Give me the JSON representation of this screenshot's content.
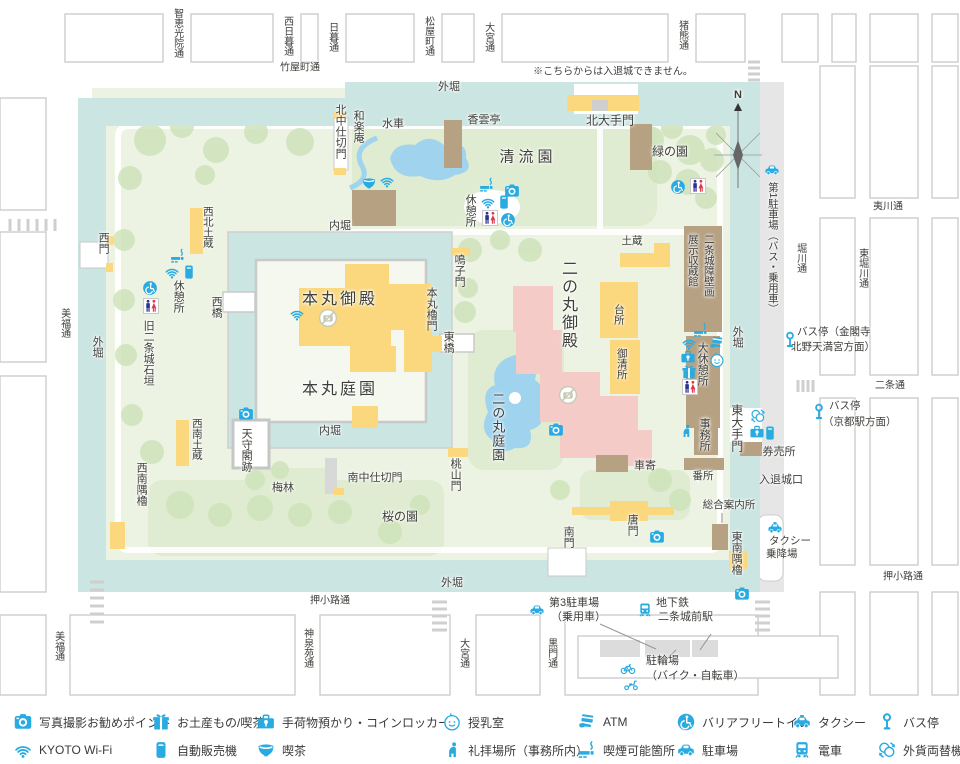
{
  "colors": {
    "blue": "#29ABE2",
    "moat": "#CBE5E2",
    "ground": "#EDF3E3",
    "lawn": "#DFECD1",
    "tree": "#CEE3BA",
    "pond": "#9FD3EE",
    "yellow": "#FBD87E",
    "pink": "#F5CBC8",
    "tan": "#B7A183",
    "grayline": "#C9C9C9",
    "sidewalk": "#E6E6E6",
    "text": "#3E3E3A",
    "male": "#2E3192",
    "female": "#E0374B"
  },
  "map": {
    "labels": [
      {
        "t": "智恵光院通",
        "o": "v",
        "x": 177,
        "y": 8,
        "s": 10
      },
      {
        "t": "西日暮通",
        "o": "v",
        "x": 287,
        "y": 16,
        "s": 10
      },
      {
        "t": "日暮通",
        "o": "v",
        "x": 332,
        "y": 22,
        "s": 10
      },
      {
        "t": "松屋町通",
        "o": "v",
        "x": 428,
        "y": 16,
        "s": 10
      },
      {
        "t": "大宮通",
        "o": "v",
        "x": 488,
        "y": 22,
        "s": 10
      },
      {
        "t": "猪熊通",
        "o": "v",
        "x": 682,
        "y": 20,
        "s": 10
      },
      {
        "t": "竹屋町通",
        "o": "h",
        "x": 300,
        "y": 68,
        "s": 10
      },
      {
        "t": "※こちらからは入退城できません。",
        "o": "h",
        "x": 613,
        "y": 72,
        "s": 10
      },
      {
        "t": "外堀",
        "o": "h",
        "x": 449,
        "y": 87,
        "s": 11
      },
      {
        "t": "N",
        "o": "h",
        "x": 738,
        "y": 95,
        "s": 11,
        "b": 1
      },
      {
        "t": "北大手門",
        "o": "h",
        "x": 610,
        "y": 121,
        "s": 12
      },
      {
        "t": "緑の園",
        "o": "h",
        "x": 670,
        "y": 152,
        "s": 12
      },
      {
        "t": "清流園",
        "o": "h",
        "x": 528,
        "y": 158,
        "s": 15,
        "ls": 4
      },
      {
        "t": "水車",
        "o": "h",
        "x": 393,
        "y": 124,
        "s": 11
      },
      {
        "t": "香雲亭",
        "o": "h",
        "x": 484,
        "y": 120,
        "s": 11
      },
      {
        "t": "和楽庵",
        "o": "v",
        "x": 358,
        "y": 110,
        "s": 11
      },
      {
        "t": "北中仕切門",
        "o": "v",
        "x": 340,
        "y": 104,
        "s": 11
      },
      {
        "t": "休憩所",
        "o": "v",
        "x": 470,
        "y": 194,
        "s": 11
      },
      {
        "t": "土蔵",
        "o": "h",
        "x": 632,
        "y": 242,
        "s": 10.5
      },
      {
        "t": "西北土蔵",
        "o": "v",
        "x": 207,
        "y": 206,
        "s": 10.5
      },
      {
        "t": "内堀",
        "o": "h",
        "x": 340,
        "y": 226,
        "s": 11
      },
      {
        "t": "鳴子門",
        "o": "v",
        "x": 459,
        "y": 254,
        "s": 11
      },
      {
        "t": "西門",
        "o": "v",
        "x": 103,
        "y": 232,
        "s": 11
      },
      {
        "t": "休憩所",
        "o": "v",
        "x": 178,
        "y": 280,
        "s": 11
      },
      {
        "t": "旧二条城石垣",
        "o": "v",
        "x": 148,
        "y": 320,
        "s": 11
      },
      {
        "t": "本丸御殿",
        "o": "h",
        "x": 340,
        "y": 300,
        "s": 16,
        "ls": 3
      },
      {
        "t": "本丸庭園",
        "o": "h",
        "x": 340,
        "y": 390,
        "s": 16,
        "ls": 3
      },
      {
        "t": "本丸櫓門",
        "o": "v",
        "x": 431,
        "y": 287,
        "s": 11
      },
      {
        "t": "東橋",
        "o": "v",
        "x": 448,
        "y": 331,
        "s": 11
      },
      {
        "t": "西橋",
        "o": "v",
        "x": 216,
        "y": 296,
        "s": 11
      },
      {
        "t": "二の丸御殿",
        "o": "v",
        "x": 567,
        "y": 260,
        "s": 16,
        "ls": 2
      },
      {
        "t": "台所",
        "o": "v",
        "x": 618,
        "y": 304,
        "s": 10.5
      },
      {
        "t": "御清所",
        "o": "v",
        "x": 621,
        "y": 348,
        "s": 10.5
      },
      {
        "t": "展示収蔵館",
        "o": "v",
        "x": 692,
        "y": 234,
        "s": 10.5
      },
      {
        "t": "二条城障壁画",
        "o": "v",
        "x": 708,
        "y": 234,
        "s": 10.5
      },
      {
        "t": "大休憩所",
        "o": "v",
        "x": 702,
        "y": 342,
        "s": 11
      },
      {
        "t": "事務所",
        "o": "v",
        "x": 704,
        "y": 418,
        "s": 11
      },
      {
        "t": "外堀",
        "o": "v",
        "x": 737,
        "y": 326,
        "s": 11
      },
      {
        "t": "外堀",
        "o": "v",
        "x": 97,
        "y": 336,
        "s": 11
      },
      {
        "t": "東大手門",
        "o": "v",
        "x": 736,
        "y": 404,
        "s": 12
      },
      {
        "t": "二の丸庭園",
        "o": "v",
        "x": 497,
        "y": 392,
        "s": 13,
        "ls": 1
      },
      {
        "t": "桜の園",
        "o": "h",
        "x": 400,
        "y": 517,
        "s": 12
      },
      {
        "t": "梅林",
        "o": "h",
        "x": 283,
        "y": 488,
        "s": 11
      },
      {
        "t": "天守閣跡",
        "o": "v",
        "x": 246,
        "y": 428,
        "s": 11
      },
      {
        "t": "西南土蔵",
        "o": "v",
        "x": 196,
        "y": 418,
        "s": 10.5
      },
      {
        "t": "西南隅櫓",
        "o": "v",
        "x": 141,
        "y": 462,
        "s": 11
      },
      {
        "t": "南中仕切門",
        "o": "h",
        "x": 375,
        "y": 478,
        "s": 11
      },
      {
        "t": "桃山門",
        "o": "v",
        "x": 455,
        "y": 458,
        "s": 11
      },
      {
        "t": "内堀",
        "o": "h",
        "x": 330,
        "y": 431,
        "s": 11
      },
      {
        "t": "車寄",
        "o": "h",
        "x": 645,
        "y": 466,
        "s": 11
      },
      {
        "t": "番所",
        "o": "h",
        "x": 703,
        "y": 477,
        "s": 10.5
      },
      {
        "t": "券売所",
        "o": "h",
        "x": 779,
        "y": 452,
        "s": 11
      },
      {
        "t": "入退城口",
        "o": "h",
        "x": 781,
        "y": 480,
        "s": 11
      },
      {
        "t": "総合案内所",
        "o": "h",
        "x": 729,
        "y": 506,
        "s": 10.5
      },
      {
        "t": "唐門",
        "o": "v",
        "x": 632,
        "y": 514,
        "s": 11
      },
      {
        "t": "南門",
        "o": "v",
        "x": 568,
        "y": 526,
        "s": 11
      },
      {
        "t": "東南隅櫓",
        "o": "v",
        "x": 736,
        "y": 531,
        "s": 11
      },
      {
        "t": "タクシー",
        "o": "h",
        "a": "l",
        "x": 769,
        "y": 542,
        "s": 10.5
      },
      {
        "t": "乗降場",
        "o": "h",
        "a": "l",
        "x": 766,
        "y": 555,
        "s": 10.5
      },
      {
        "t": "第1駐車場（バス・乗用車）",
        "o": "v",
        "x": 772,
        "y": 182,
        "s": 10.5
      },
      {
        "t": "バス停（金閣寺",
        "o": "h",
        "a": "l",
        "x": 797,
        "y": 333,
        "s": 10.5
      },
      {
        "t": "北野天満宮方面）",
        "o": "h",
        "a": "l",
        "x": 791,
        "y": 348,
        "s": 10.5
      },
      {
        "t": "バス停",
        "o": "h",
        "a": "l",
        "x": 829,
        "y": 407,
        "s": 10.5
      },
      {
        "t": "（京都駅方面）",
        "o": "h",
        "a": "l",
        "x": 823,
        "y": 423,
        "s": 10.5
      },
      {
        "t": "堀川通",
        "o": "v",
        "x": 800,
        "y": 243,
        "s": 10
      },
      {
        "t": "東堀川通",
        "o": "v",
        "x": 862,
        "y": 248,
        "s": 10
      },
      {
        "t": "夷川通",
        "o": "h",
        "x": 888,
        "y": 207,
        "s": 10
      },
      {
        "t": "二条通",
        "o": "h",
        "x": 890,
        "y": 386,
        "s": 10
      },
      {
        "t": "押小路通",
        "o": "h",
        "x": 903,
        "y": 577,
        "s": 10
      },
      {
        "t": "外堀",
        "o": "h",
        "x": 452,
        "y": 583,
        "s": 11
      },
      {
        "t": "押小路通",
        "o": "h",
        "x": 330,
        "y": 601,
        "s": 10
      },
      {
        "t": "第3駐車場",
        "o": "h",
        "a": "l",
        "x": 549,
        "y": 603,
        "s": 11
      },
      {
        "t": "（乗用車）",
        "o": "h",
        "a": "l",
        "x": 551,
        "y": 617,
        "s": 11
      },
      {
        "t": "地下鉄",
        "o": "h",
        "a": "l",
        "x": 656,
        "y": 603,
        "s": 11
      },
      {
        "t": "二条城前駅",
        "o": "h",
        "a": "l",
        "x": 658,
        "y": 617,
        "s": 11
      },
      {
        "t": "駐輪場",
        "o": "h",
        "a": "l",
        "x": 646,
        "y": 661,
        "s": 11
      },
      {
        "t": "（バイク・自転車）",
        "o": "h",
        "a": "l",
        "x": 646,
        "y": 676,
        "s": 11
      },
      {
        "t": "美福通",
        "o": "v",
        "x": 64,
        "y": 308,
        "s": 10
      },
      {
        "t": "美福通",
        "o": "v",
        "x": 58,
        "y": 631,
        "s": 10
      },
      {
        "t": "神泉苑通",
        "o": "v",
        "x": 307,
        "y": 628,
        "s": 10
      },
      {
        "t": "大宮通",
        "o": "v",
        "x": 463,
        "y": 638,
        "s": 10
      },
      {
        "t": "黒門通",
        "o": "v",
        "x": 551,
        "y": 638,
        "s": 10
      }
    ],
    "icons": [
      {
        "n": "camera",
        "x": 512,
        "y": 191
      },
      {
        "n": "camera",
        "x": 246,
        "y": 414
      },
      {
        "n": "camera",
        "x": 556,
        "y": 430
      },
      {
        "n": "camera",
        "x": 657,
        "y": 537
      },
      {
        "n": "camera",
        "x": 742,
        "y": 594
      },
      {
        "n": "nophoto",
        "x": 328,
        "y": 318,
        "sz": 19
      },
      {
        "n": "nophoto",
        "x": 568,
        "y": 395,
        "sz": 19
      },
      {
        "n": "wifi",
        "x": 387,
        "y": 181
      },
      {
        "n": "wifi",
        "x": 488,
        "y": 202
      },
      {
        "n": "wifi",
        "x": 297,
        "y": 314
      },
      {
        "n": "wifi",
        "x": 172,
        "y": 272
      },
      {
        "n": "wifi",
        "x": 689,
        "y": 343
      },
      {
        "n": "tea",
        "x": 369,
        "y": 183
      },
      {
        "n": "smoking",
        "x": 487,
        "y": 185
      },
      {
        "n": "smoking",
        "x": 178,
        "y": 256
      },
      {
        "n": "smoking",
        "x": 701,
        "y": 330
      },
      {
        "n": "vending",
        "x": 504,
        "y": 202
      },
      {
        "n": "vending",
        "x": 189,
        "y": 272
      },
      {
        "n": "vending",
        "x": 770,
        "y": 433
      },
      {
        "n": "toilets",
        "x": 490,
        "y": 218,
        "sz": 16
      },
      {
        "n": "toilets",
        "x": 151,
        "y": 306,
        "sz": 16
      },
      {
        "n": "toilets",
        "x": 698,
        "y": 186,
        "sz": 16
      },
      {
        "n": "toilets",
        "x": 690,
        "y": 387,
        "sz": 16
      },
      {
        "n": "accessible",
        "x": 508,
        "y": 220
      },
      {
        "n": "accessible",
        "x": 150,
        "y": 288
      },
      {
        "n": "accessible",
        "x": 678,
        "y": 187
      },
      {
        "n": "baby",
        "x": 717,
        "y": 360
      },
      {
        "n": "gift",
        "x": 689,
        "y": 372
      },
      {
        "n": "locker",
        "x": 688,
        "y": 357
      },
      {
        "n": "locker",
        "x": 757,
        "y": 432
      },
      {
        "n": "atm",
        "x": 717,
        "y": 343
      },
      {
        "n": "prayer",
        "x": 686,
        "y": 431
      },
      {
        "n": "car",
        "x": 772,
        "y": 170
      },
      {
        "n": "car",
        "x": 537,
        "y": 610
      },
      {
        "n": "train",
        "x": 645,
        "y": 610
      },
      {
        "n": "bus",
        "x": 790,
        "y": 340,
        "sz": 17
      },
      {
        "n": "bus",
        "x": 819,
        "y": 412,
        "sz": 17
      },
      {
        "n": "taxi",
        "x": 775,
        "y": 528
      },
      {
        "n": "exchange",
        "x": 758,
        "y": 416
      },
      {
        "n": "bicycle",
        "x": 628,
        "y": 668
      },
      {
        "n": "scooter",
        "x": 631,
        "y": 684
      }
    ]
  },
  "legend": {
    "row_y": [
      722,
      750
    ],
    "rows": [
      [
        {
          "icon": "camera",
          "label": "写真撮影お勧めポイント",
          "x": 14
        },
        {
          "icon": "gift",
          "label": "お土産もの/喫茶",
          "x": 152
        },
        {
          "icon": "locker",
          "label": "手荷物預かり・コインロッカー",
          "x": 257
        },
        {
          "icon": "baby",
          "label": "授乳室",
          "x": 443
        },
        {
          "icon": "atm",
          "label": "ATM",
          "x": 578
        },
        {
          "icon": "accessible",
          "label": "バリアフリートイレ",
          "x": 677
        },
        {
          "icon": "taxi",
          "label": "タクシー",
          "x": 793
        },
        {
          "icon": "bus",
          "label": "バス停",
          "x": 878
        }
      ],
      [
        {
          "icon": "wifi",
          "label": "KYOTO Wi-Fi",
          "x": 14
        },
        {
          "icon": "vending",
          "label": "自動販売機",
          "x": 152
        },
        {
          "icon": "tea",
          "label": "喫茶",
          "x": 257
        },
        {
          "icon": "prayer",
          "label": "礼拝場所（事務所内）",
          "x": 443
        },
        {
          "icon": "smoking",
          "label": "喫煙可能箇所",
          "x": 578
        },
        {
          "icon": "car",
          "label": "駐車場",
          "x": 677
        },
        {
          "icon": "train",
          "label": "電車",
          "x": 793
        },
        {
          "icon": "exchange",
          "label": "外貨両替機",
          "x": 878
        }
      ]
    ]
  }
}
